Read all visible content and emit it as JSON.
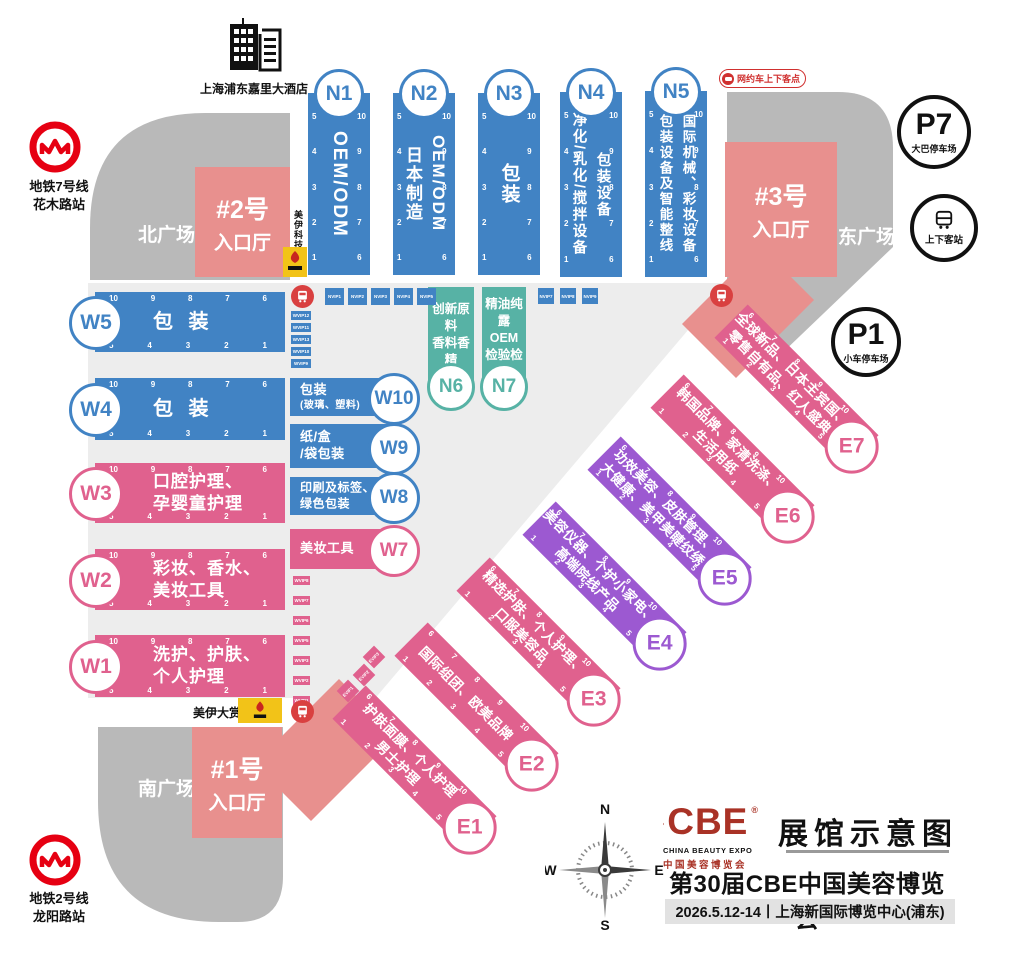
{
  "colors": {
    "hall_blue": "#4183c4",
    "hall_pink": "#e0618e",
    "hall_purple": "#9c59d1",
    "hall_teal": "#57b2a5",
    "entrance_salmon": "#e8908e",
    "plaza_gray": "#b9b9b9",
    "floor_gray": "#ededed",
    "metro_red": "#e60012",
    "bus_red": "#d94040",
    "cbe_red": "#a93226",
    "sponsor_yellow": "#f2c318"
  },
  "hotel": {
    "label": "上海浦东嘉里大酒店"
  },
  "metro": {
    "north": {
      "line": "地铁7号线",
      "station": "花木路站"
    },
    "south": {
      "line": "地铁2号线",
      "station": "龙阳路站"
    }
  },
  "plazas": {
    "north": "北广场",
    "east": "东广场",
    "south": "南广场"
  },
  "entrances": {
    "h1": {
      "no": "#1号",
      "label": "入口厅"
    },
    "h2": {
      "no": "#2号",
      "label": "入口厅"
    },
    "h3": {
      "no": "#3号",
      "label": "入口厅"
    }
  },
  "parking": {
    "p7": {
      "code": "P7",
      "label": "大巴停车场"
    },
    "p1": {
      "code": "P1",
      "label": "小车停车场"
    }
  },
  "transport": {
    "bus_stop": "上下客站",
    "ride_hailing": "网约车上下客点"
  },
  "sponsor": {
    "tech": "美伊科技",
    "award": "美伊大赏"
  },
  "booths": {
    "w_top": [
      "10",
      "9",
      "8",
      "7",
      "6"
    ],
    "w_bottom": [
      "5",
      "4",
      "3",
      "2",
      "1"
    ],
    "n_left": [
      "5",
      "4",
      "3",
      "2",
      "1"
    ],
    "n_right": [
      "10",
      "9",
      "8",
      "7",
      "6"
    ],
    "e_top": [
      "6",
      "7",
      "8",
      "9",
      "10"
    ],
    "e_bottom": [
      "1",
      "2",
      "3",
      "4",
      "5"
    ]
  },
  "vip": {
    "n_row_left": [
      "NVIP1",
      "NVIP2",
      "NVIP3",
      "NVIP4",
      "NVIP5"
    ],
    "n_row_right": [
      "NVIP7",
      "NVIP8",
      "NVIP9"
    ],
    "w_stack_blue": [
      "WVIP12",
      "WVIP11",
      "WVIP13",
      "WVIP10",
      "WVIP9"
    ],
    "w_stack_pink": [
      "WVIP8",
      "WVIP7",
      "WVIP6",
      "WVIP5",
      "WVIP3",
      "WVIP2",
      "WVIP1"
    ],
    "e_boxes": [
      "EVIP3",
      "EVIP2",
      "EVIP1"
    ]
  },
  "halls": {
    "N1": {
      "code": "N1",
      "lines": [
        "OEM/ODM"
      ]
    },
    "N2": {
      "code": "N2",
      "lines": [
        "OEM/ODM",
        "日本制造"
      ]
    },
    "N3": {
      "code": "N3",
      "lines": [
        "包装"
      ]
    },
    "N4": {
      "code": "N4",
      "lines": [
        "包装设备",
        "净化/乳化/搅拌设备"
      ]
    },
    "N5": {
      "code": "N5",
      "lines": [
        "国际机械、彩妆设备",
        "包装设备及智能整线"
      ]
    },
    "N6": {
      "code": "N6",
      "lines": [
        "创新原料",
        "香料香精"
      ]
    },
    "N7": {
      "code": "N7",
      "lines": [
        "精油纯露",
        "OEM",
        "检验检测"
      ]
    },
    "W1": {
      "code": "W1",
      "lines": [
        "洗护、护肤、",
        "个人护理"
      ]
    },
    "W2": {
      "code": "W2",
      "lines": [
        "彩妆、香水、",
        "美妆工具"
      ]
    },
    "W3": {
      "code": "W3",
      "lines": [
        "口腔护理、",
        "孕婴童护理"
      ]
    },
    "W4": {
      "code": "W4",
      "lines": [
        "包 装"
      ]
    },
    "W5": {
      "code": "W5",
      "lines": [
        "包 装"
      ]
    },
    "W7": {
      "code": "W7",
      "lines": [
        "美妆工具"
      ]
    },
    "W8": {
      "code": "W8",
      "lines": [
        "印刷及标签、",
        "绿色包装"
      ]
    },
    "W9": {
      "code": "W9",
      "lines": [
        "纸/盒",
        "/袋包装"
      ]
    },
    "W10": {
      "code": "W10",
      "lines": [
        "包装",
        "(玻璃、塑料)"
      ]
    },
    "E1": {
      "code": "E1",
      "lines": [
        "护肤面膜、个人护理",
        "男士护理"
      ]
    },
    "E2": {
      "code": "E2",
      "lines": [
        "国际组团、欧美品牌"
      ]
    },
    "E3": {
      "code": "E3",
      "lines": [
        "精选护肤、个人护理、",
        "口服美容品"
      ]
    },
    "E4": {
      "code": "E4",
      "lines": [
        "美容仪器、个护小家电、",
        "高端院线产品"
      ]
    },
    "E5": {
      "code": "E5",
      "lines": [
        "功效美容、皮肤管理、",
        "大健康、美甲美睫纹绣"
      ]
    },
    "E6": {
      "code": "E6",
      "lines": [
        "韩国品牌、家清洗涤、",
        "生活用纸"
      ]
    },
    "E7": {
      "code": "E7",
      "lines": [
        "全球新品、日本主宾国、",
        "零售自有品、红人盛典"
      ]
    }
  },
  "title_block": {
    "heading": "展馆示意图",
    "expo_name": "第30届CBE中国美容博览会",
    "date_venue": "2026.5.12-14丨上海新国际博览中心(浦东)",
    "logo": {
      "text": "CBE",
      "reg": "®",
      "en": "CHINA BEAUTY EXPO",
      "cn": "中国美容博览会"
    }
  },
  "compass": {
    "n": "N",
    "e": "E",
    "s": "S",
    "w": "W"
  }
}
